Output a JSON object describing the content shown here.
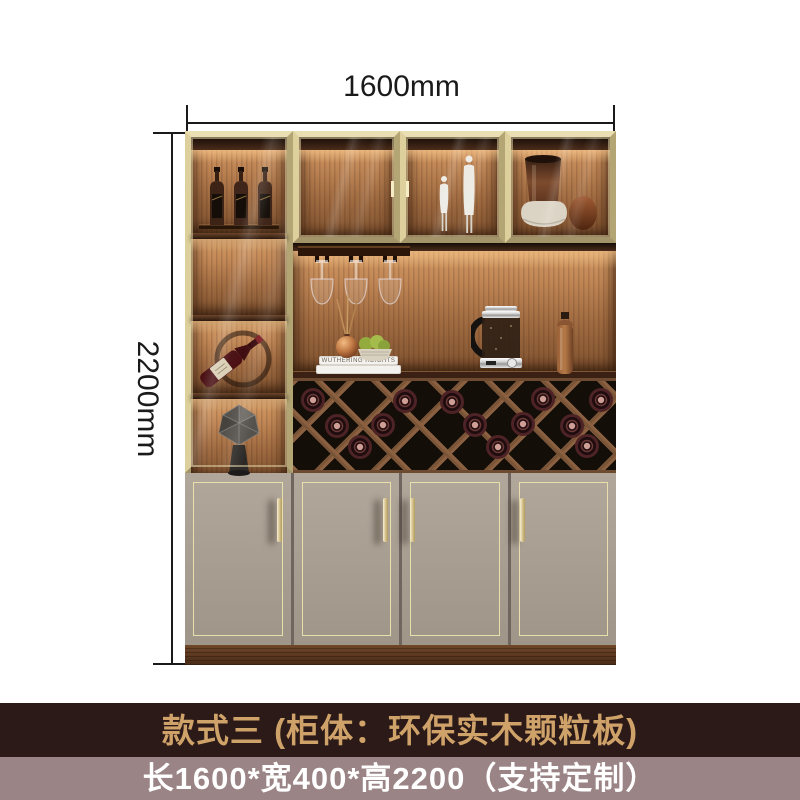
{
  "dimensions": {
    "width_label": "1600mm",
    "height_label": "2200mm"
  },
  "banners": {
    "style_text": "款式三 (柜体：环保实木颗粒板)",
    "size_text": "长1600*宽400*高2200（支持定制）"
  },
  "decor": {
    "book_spine_text": "WUTHERING  HEIGHTS"
  },
  "colors": {
    "dimension_line_color": "#1a1a1a",
    "banner_dark_bg": "#2b1a17",
    "banner_dark_text": "#cfa269",
    "banner_light_bg": "#9b8485",
    "banner_light_text": "#ffffff",
    "frame_gold": "#c9ba86",
    "door_color": "#aba093",
    "door_trim_gold": "#e9dfac",
    "rack_wood": "#7a5437",
    "rack_bg": "#140e09",
    "plinth_wood": "#5a3a22"
  }
}
